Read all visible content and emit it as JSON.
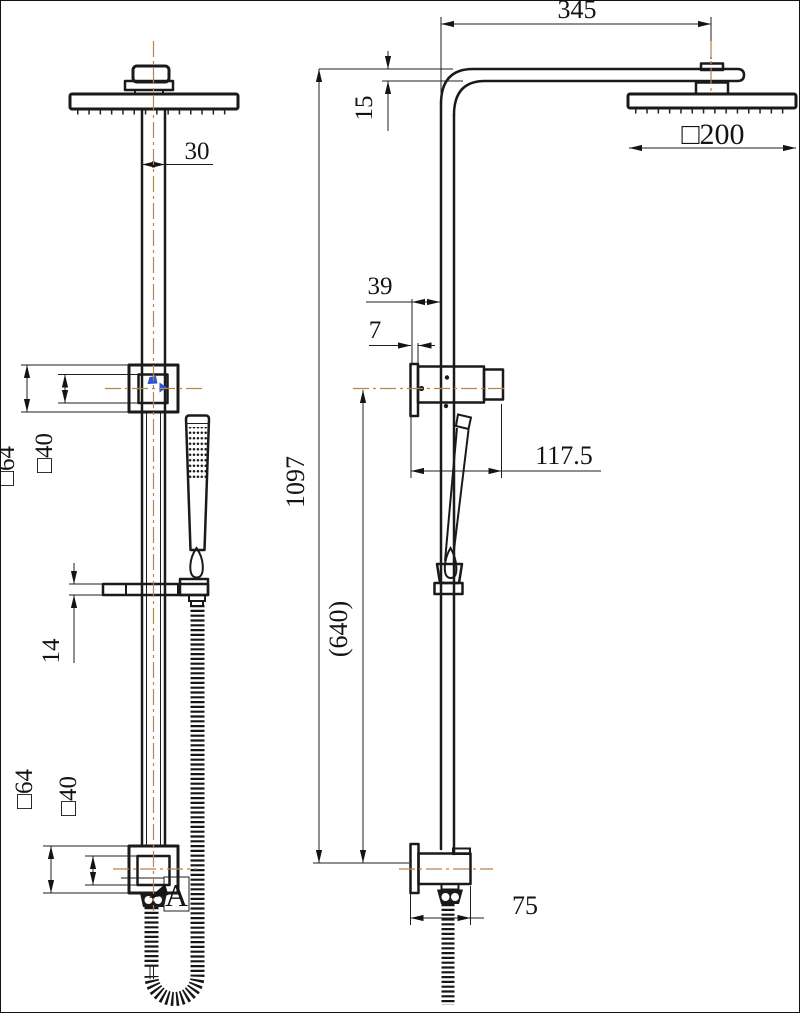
{
  "drawing": {
    "kind": "shower-column-dimension-drawing",
    "views": {
      "left": "front view",
      "right": "side view"
    }
  },
  "labels": {
    "front": {
      "pipe_width": "30",
      "upper_bracket_outer": "□64",
      "upper_bracket_inner": "□40",
      "slider_bar_height": "14",
      "lower_bracket_outer": "□64",
      "lower_bracket_inner": "□40",
      "detail_marker": "A"
    },
    "side": {
      "arm_reach": "345",
      "arm_height": "15",
      "head_size": "□200",
      "bracket_offset": "39",
      "wall_plate_thickness": "7",
      "handset_span": "117.5",
      "overall_height": "1097",
      "bracket_spacing": "(640)",
      "lower_bracket_depth": "75"
    }
  },
  "colors": {
    "line": "#1a1a1a",
    "centerline": "#b5854e",
    "accent_blue": "#2e54d6"
  }
}
